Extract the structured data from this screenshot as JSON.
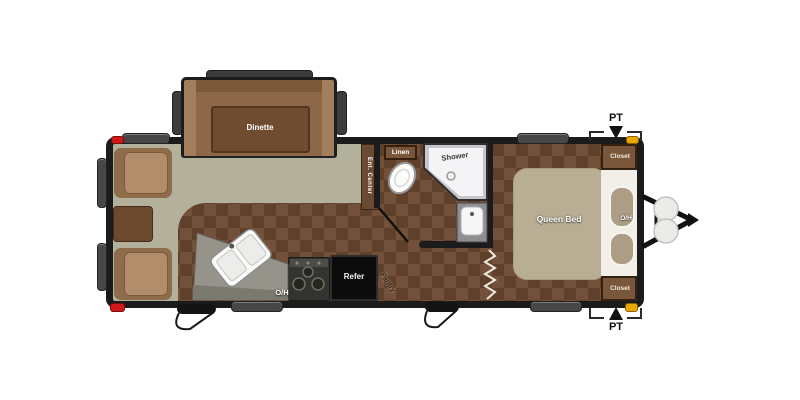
{
  "title": "Travel trailer floor plan",
  "labels": {
    "dinette": "Dinette",
    "linen": "Linen",
    "shower": "Shower",
    "ent_center": "Ent. Center",
    "overhead_kitchen": "O/H",
    "refer": "Refer",
    "pantry": "Pantry",
    "queen_bed": "Queen Bed",
    "overhead_bed": "O/H",
    "closet_top": "Closet",
    "closet_bottom": "Closet",
    "pt_top": "PT",
    "pt_bottom": "PT"
  },
  "colors": {
    "wall": "#1b1b1b",
    "carpet": "#73503a",
    "carpet_dark": "#5f402b",
    "lino_floor": "#b3b09b",
    "bed": "#b9ad93",
    "cabinet_wood": "#7a573a",
    "marker_red": "#d01818",
    "marker_amber": "#e8a800"
  }
}
